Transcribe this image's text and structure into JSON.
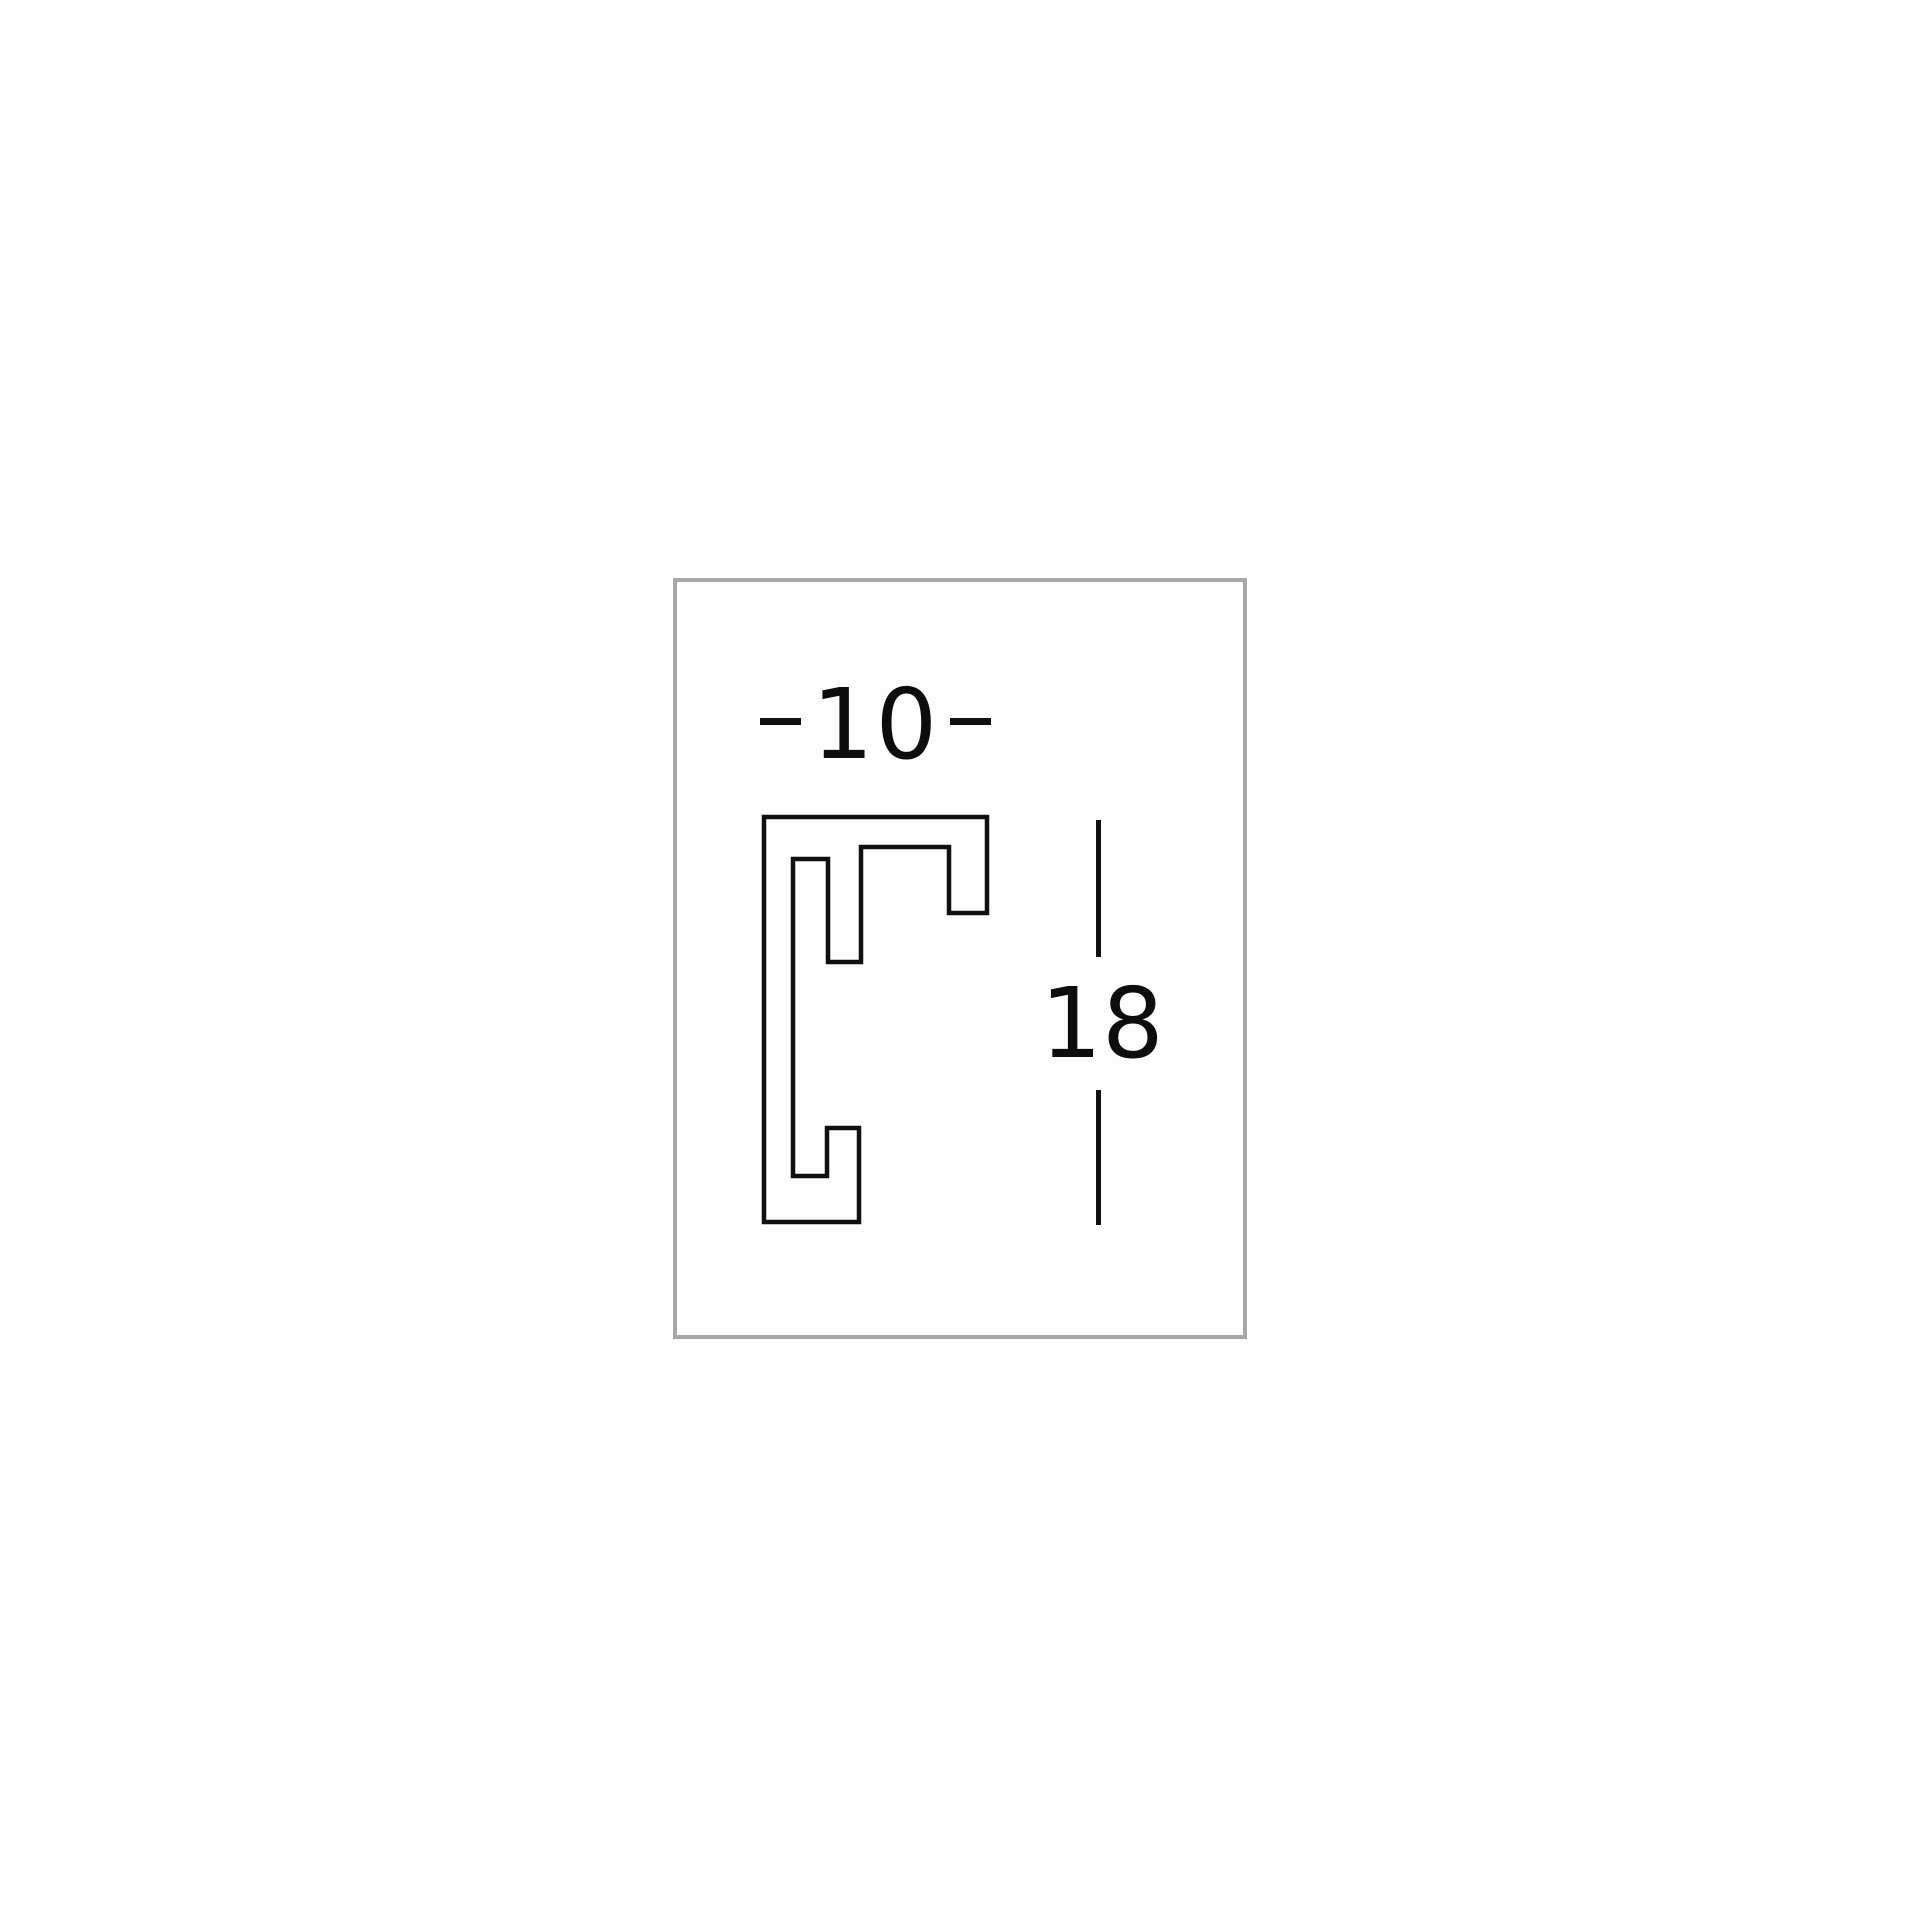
{
  "diagram": {
    "description": "Picture-frame moulding profile cross-section with dimensions",
    "line_color": "#101010",
    "text_color": "#0d0d0d",
    "panel_border_color": "#a7a7a7",
    "panel_background": "#fdfdfd",
    "page_background": "#ffffff",
    "width_dimension": {
      "label": "10"
    },
    "height_dimension": {
      "label": "18"
    },
    "profile_outline_points": "4,4 227,4 227,100 189,100 189,34 101,34 101,149 68,149 68,46 33,46 33,363 67,363 67,315 99,315 99,409 4,409"
  }
}
